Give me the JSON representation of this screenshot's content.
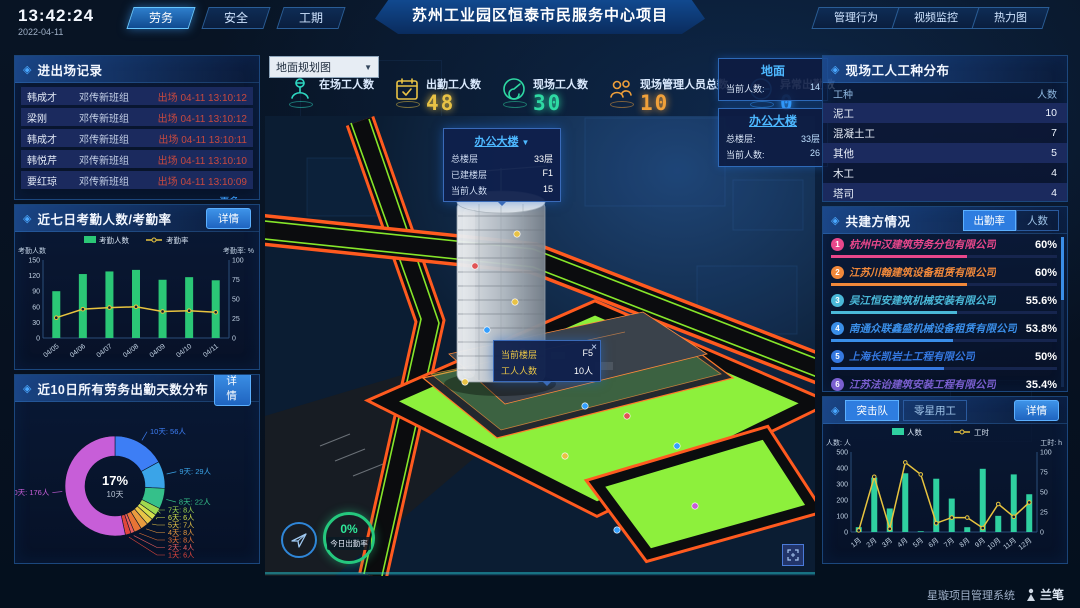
{
  "icons": {
    "diamond": "◈",
    "caret_down": "▼",
    "close": "×"
  },
  "topbar": {
    "time": "13:42:24",
    "date": "2022-04-11",
    "left_tabs": [
      {
        "label": "劳务",
        "active": true
      },
      {
        "label": "安全",
        "active": false
      },
      {
        "label": "工期",
        "active": false
      }
    ],
    "title": "苏州工业园区恒泰市民服务中心项目",
    "right_tabs": [
      {
        "label": "管理行为",
        "active": false
      },
      {
        "label": "视频监控",
        "active": false
      },
      {
        "label": "热力图",
        "active": false
      }
    ]
  },
  "entry_exit": {
    "title": "进出场记录",
    "rows": [
      {
        "name": "韩成才",
        "group": "邓传新班组",
        "event": "出场 04-11 13:10:12"
      },
      {
        "name": "梁刚",
        "group": "邓传新班组",
        "event": "出场 04-11 13:10:12"
      },
      {
        "name": "韩成才",
        "group": "邓传新班组",
        "event": "出场 04-11 13:10:11"
      },
      {
        "name": "韩悦芹",
        "group": "邓传新班组",
        "event": "出场 04-11 13:10:10"
      },
      {
        "name": "要红琼",
        "group": "邓传新班组",
        "event": "出场 04-11 13:10:09"
      }
    ],
    "more_label": "更多>>",
    "event_color": "#c8493f"
  },
  "attendance7": {
    "title": "近七日考勤人数/考勤率",
    "detail_label": "详情",
    "chart_data": {
      "type": "bar+line",
      "categories": [
        "04/05",
        "04/06",
        "04/07",
        "04/08",
        "04/09",
        "04/10",
        "04/11"
      ],
      "series": [
        {
          "name": "考勤人数",
          "type": "bar",
          "values": [
            90,
            123,
            128,
            131,
            112,
            117,
            111
          ],
          "color": "#2bc776"
        },
        {
          "name": "考勤率",
          "type": "line",
          "values": [
            26,
            37,
            39,
            40,
            34,
            35,
            33
          ],
          "color": "#e8c43f"
        }
      ],
      "left_axis": {
        "label": "考勤人数",
        "max": 150,
        "ticks": [
          0,
          30,
          60,
          90,
          120,
          150
        ]
      },
      "right_axis": {
        "label": "考勤率: %",
        "max": 100,
        "ticks": [
          0,
          25,
          50,
          75,
          100
        ]
      },
      "legend_position": "top"
    }
  },
  "distribution10": {
    "title": "近10日所有劳务出勤天数分布",
    "detail_label": "详情",
    "center": {
      "pct": "17%",
      "label": "10天"
    },
    "chart_data": {
      "type": "pie",
      "title": "近10日所有劳务出勤天数分布",
      "slices": [
        {
          "label": "10天",
          "value": 56,
          "display": "10天: 56人",
          "color": "#3d7ef5"
        },
        {
          "label": "9天",
          "value": 29,
          "display": "9天: 29人",
          "color": "#3aa4e8"
        },
        {
          "label": "8天",
          "value": 22,
          "display": "8天: 22人",
          "color": "#35c08a"
        },
        {
          "label": "7天",
          "value": 8,
          "display": "7天: 8人",
          "color": "#9fd94f"
        },
        {
          "label": "6天",
          "value": 6,
          "display": "6天: 6人",
          "color": "#d4e04c"
        },
        {
          "label": "5天",
          "value": 7,
          "display": "5天: 7人",
          "color": "#e8c547"
        },
        {
          "label": "4天",
          "value": 8,
          "display": "4天: 8人",
          "color": "#e89b3f"
        },
        {
          "label": "3天",
          "value": 8,
          "display": "3天: 8人",
          "color": "#e87435"
        },
        {
          "label": "2天",
          "value": 4,
          "display": "2天: 4人",
          "color": "#e85e5e"
        },
        {
          "label": "1天",
          "value": 6,
          "display": "1天: 6人",
          "color": "#e0463c"
        },
        {
          "label": "0天",
          "value": 176,
          "display": "0天: 176人",
          "color": "#c75ed8"
        }
      ]
    }
  },
  "map": {
    "dropdown": "地面规划图",
    "stats": [
      {
        "label": "在场工人数",
        "value": "",
        "color": "#2ed9c3",
        "icon": "worker-icon"
      },
      {
        "label": "出勤工人数",
        "value": "48",
        "color": "#e8c245",
        "icon": "calendar-check-icon"
      },
      {
        "label": "现场工人数",
        "value": "30",
        "color": "#2ed9a3",
        "icon": "gauge-icon"
      },
      {
        "label": "现场管理人员总数",
        "value": "10",
        "color": "#f0a03a",
        "icon": "group-icon"
      },
      {
        "label": "异常出勤数",
        "value": "0",
        "color": "#35a0ff",
        "icon": "pulse-icon"
      }
    ],
    "building_tooltip": {
      "title": "办公大楼",
      "rows": [
        {
          "label": "总楼层",
          "value": "33层"
        },
        {
          "label": "已建楼层",
          "value": "F1"
        },
        {
          "label": "当前人数",
          "value": "15"
        }
      ]
    },
    "floor_tooltip": {
      "rows": [
        {
          "label": "当前楼层",
          "value": "F5"
        },
        {
          "label": "工人人数",
          "value": "10人"
        }
      ]
    },
    "info_boxes": [
      {
        "title": "地面",
        "underline": false,
        "rows": [
          {
            "label": "当前人数:",
            "value": "14"
          }
        ]
      },
      {
        "title": "办公大楼",
        "underline": true,
        "rows": [
          {
            "label": "总楼层:",
            "value": "33层"
          },
          {
            "label": "当前人数:",
            "value": "26"
          }
        ]
      }
    ],
    "gauge": {
      "value": "0%",
      "label": "今日出勤率"
    }
  },
  "worker_types": {
    "title": "现场工人工种分布",
    "headers": [
      "工种",
      "人数"
    ],
    "rows": [
      {
        "type": "泥工",
        "count": "10"
      },
      {
        "type": "混凝土工",
        "count": "7"
      },
      {
        "type": "其他",
        "count": "5"
      },
      {
        "type": "木工",
        "count": "4"
      },
      {
        "type": "塔司",
        "count": "4"
      }
    ]
  },
  "partners": {
    "title": "共建方情况",
    "tabs": [
      {
        "label": "出勤率",
        "active": true
      },
      {
        "label": "人数",
        "active": false
      }
    ],
    "rows": [
      {
        "rank": "1",
        "name": "杭州中汉建筑劳务分包有限公司",
        "value": "60%",
        "pct": 60,
        "color": "#e8478b"
      },
      {
        "rank": "2",
        "name": "江苏川翰建筑设备租赁有限公司",
        "value": "60%",
        "pct": 60,
        "color": "#f0883a"
      },
      {
        "rank": "3",
        "name": "吴江恒安建筑机械安装有限公司",
        "value": "55.6%",
        "pct": 55.6,
        "color": "#4ab8d8"
      },
      {
        "rank": "4",
        "name": "南通众联鑫盛机械设备租赁有限公司",
        "value": "53.8%",
        "pct": 53.8,
        "color": "#3a8ee8"
      },
      {
        "rank": "5",
        "name": "上海长凯岩土工程有限公司",
        "value": "50%",
        "pct": 50,
        "color": "#3578e0"
      },
      {
        "rank": "6",
        "name": "江苏法诒建筑安装工程有限公司",
        "value": "35.4%",
        "pct": 35.4,
        "color": "#7a5fd0"
      }
    ]
  },
  "squad": {
    "tabs": [
      {
        "label": "突击队",
        "active": true
      },
      {
        "label": "零星用工",
        "active": false
      }
    ],
    "detail_label": "详情",
    "chart_data": {
      "type": "bar+line",
      "categories": [
        "1月",
        "2月",
        "3月",
        "4月",
        "5月",
        "6月",
        "7月",
        "8月",
        "9月",
        "10月",
        "11月",
        "12月"
      ],
      "series": [
        {
          "name": "人数",
          "type": "bar",
          "values": [
            30,
            340,
            147,
            367,
            5,
            333,
            209,
            30,
            395,
            101,
            360,
            236
          ],
          "color": "#2fd0a0"
        },
        {
          "name": "工时",
          "type": "line",
          "values": [
            2,
            69,
            4,
            87,
            72,
            11,
            18,
            18,
            5,
            35,
            19,
            37
          ],
          "color": "#e8c43f"
        }
      ],
      "left_axis": {
        "label": "人数: 人",
        "max": 500,
        "ticks": [
          0,
          100,
          200,
          300,
          400,
          500
        ]
      },
      "right_axis": {
        "label": "工时: h",
        "max": 100,
        "ticks": [
          0,
          25,
          50,
          75,
          100
        ]
      },
      "legend_position": "top"
    }
  },
  "footer": {
    "system_name": "星璇项目管理系统",
    "logo_text": "兰笔"
  }
}
